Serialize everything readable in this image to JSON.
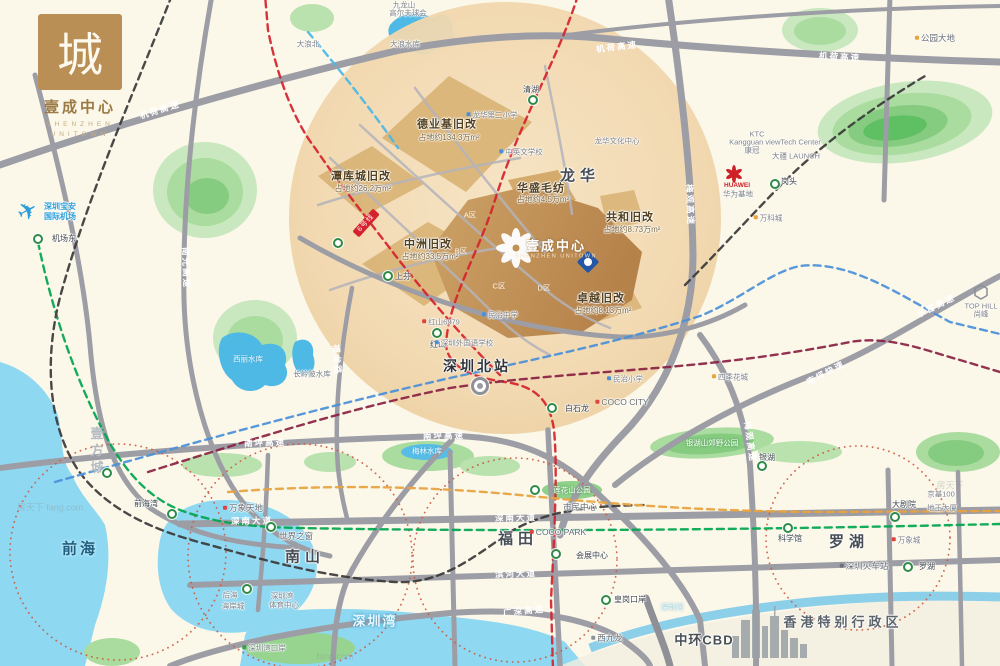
{
  "brand": {
    "logo_char": "城",
    "title": "壹成中心",
    "subtitle1": "SHENZHEN",
    "subtitle2": "UNITOWN"
  },
  "palette": {
    "land": "#fbf7e9",
    "sea": "#8ed8f2",
    "lake": "#4fb9e6",
    "park_outer": "#c9e8bf",
    "park_inner": "#86cc80",
    "road": "#9d9da5",
    "project_circle": "#efd3a6",
    "zone_block": "#d9b478",
    "project_block": "#c0914f",
    "metro_red": "#d5232e",
    "metro_green": "#00a650",
    "metro_blue": "#4a90d9",
    "metro_black": "#3a3a3a",
    "metro_orange": "#e8a33d",
    "metro_maroon": "#8a2243",
    "metro_cyan": "#49b8e8",
    "district_ring": "#cd5a3e"
  },
  "map": {
    "labels": [
      {
        "t": "机荷高速",
        "x": 160,
        "y": 110,
        "c": "road",
        "r": -17,
        "n": "road-jihe-expwy"
      },
      {
        "t": "机荷高速",
        "x": 617,
        "y": 47,
        "c": "road",
        "r": -7
      },
      {
        "t": "机荷高速",
        "x": 840,
        "y": 57,
        "c": "road",
        "r": 3
      },
      {
        "t": "南光高速",
        "x": 186,
        "y": 268,
        "c": "road",
        "r": 88,
        "n": "road-nanguang-expwy"
      },
      {
        "t": "梅观高速",
        "x": 690,
        "y": 205,
        "c": "road",
        "r": 88,
        "n": "road-meiguan-expwy"
      },
      {
        "t": "梅观高速",
        "x": 750,
        "y": 442,
        "c": "road",
        "r": 82
      },
      {
        "t": "南坪高速",
        "x": 265,
        "y": 443,
        "c": "road",
        "r": -2,
        "n": "road-nanping-expwy"
      },
      {
        "t": "南坪高速",
        "x": 444,
        "y": 436,
        "c": "road",
        "r": -1
      },
      {
        "t": "水官高速",
        "x": 936,
        "y": 306,
        "c": "road",
        "r": -26,
        "n": "road-shuiguan-expwy"
      },
      {
        "t": "南坪快速",
        "x": 826,
        "y": 373,
        "c": "road",
        "r": -28
      },
      {
        "t": "深南大道",
        "x": 252,
        "y": 521,
        "c": "road",
        "r": -1,
        "n": "road-shennan-avenue"
      },
      {
        "t": "深南大道",
        "x": 516,
        "y": 518,
        "c": "road",
        "r": -1
      },
      {
        "t": "滨河大道",
        "x": 516,
        "y": 574,
        "c": "road",
        "r": -2,
        "n": "road-binhe-avenue"
      },
      {
        "t": "广深高速",
        "x": 524,
        "y": 611,
        "c": "road",
        "r": -5,
        "n": "road-guangshen-expwy"
      },
      {
        "t": "福龙路",
        "x": 337,
        "y": 360,
        "c": "road",
        "r": 86,
        "n": "road-fulong-road"
      },
      {
        "t": "龙华",
        "x": 580,
        "y": 176,
        "c": "dist halo",
        "n": "district-longhua"
      },
      {
        "t": "南山",
        "x": 305,
        "y": 557,
        "c": "dist halo",
        "n": "district-nanshan"
      },
      {
        "t": "福田",
        "x": 518,
        "y": 539,
        "c": "dist halo",
        "n": "district-futian"
      },
      {
        "t": "罗湖",
        "x": 849,
        "y": 542,
        "c": "dist halo",
        "n": "district-luohu"
      },
      {
        "t": "前海",
        "x": 80,
        "y": 549,
        "c": "distw",
        "n": "district-qianhai"
      },
      {
        "t": "深圳湾",
        "x": 375,
        "y": 621,
        "c": "watbig",
        "n": "shenzhen-bay-label"
      },
      {
        "t": "香港特别行政区",
        "x": 843,
        "y": 622,
        "c": "hk halo",
        "n": "hongkong-sar-label"
      },
      {
        "t": "中环CBD",
        "x": 704,
        "y": 640,
        "c": "cbd halo",
        "n": "central-cbd-label"
      },
      {
        "t": "西九龙",
        "x": 607,
        "y": 638,
        "c": "poi halo",
        "d": "#8d939a"
      },
      {
        "t": "深圳河",
        "x": 672,
        "y": 607,
        "c": "wat"
      },
      {
        "t": "深圳北站",
        "x": 477,
        "y": 366,
        "c": "bigstn halo",
        "n": "shenzhen-north-station-label"
      },
      {
        "t": "德业基旧改",
        "x": 447,
        "y": 125,
        "c": "zone halo",
        "n": "zone-deyeji"
      },
      {
        "t": "占地约134.3万m²",
        "x": 449,
        "y": 138,
        "c": "zsub halo"
      },
      {
        "t": "潭库城旧改",
        "x": 361,
        "y": 177,
        "c": "zone halo",
        "n": "zone-tankucheng"
      },
      {
        "t": "占地约26.2万m²",
        "x": 363,
        "y": 189,
        "c": "zsub halo"
      },
      {
        "t": "中洲旧改",
        "x": 428,
        "y": 245,
        "c": "zone halo",
        "n": "zone-zhongzhou"
      },
      {
        "t": "占地约33.5万m²",
        "x": 430,
        "y": 257,
        "c": "zsub halo"
      },
      {
        "t": "华盛毛纺",
        "x": 541,
        "y": 189,
        "c": "zone halo",
        "n": "zone-huasheng"
      },
      {
        "t": "占地约4.5万m²",
        "x": 543,
        "y": 200,
        "c": "zsub halo"
      },
      {
        "t": "共和旧改",
        "x": 630,
        "y": 218,
        "c": "zone halo",
        "n": "zone-gonghe"
      },
      {
        "t": "占地约8.73万m²",
        "x": 632,
        "y": 230,
        "c": "zsub halo"
      },
      {
        "t": "卓越旧改",
        "x": 601,
        "y": 299,
        "c": "zone halo",
        "n": "zone-zhuoyue"
      },
      {
        "t": "占地约8.13万m²",
        "x": 603,
        "y": 311,
        "c": "zsub halo"
      },
      {
        "t": "A区",
        "x": 470,
        "y": 215,
        "c": "blk"
      },
      {
        "t": "B区",
        "x": 461,
        "y": 251,
        "c": "blk"
      },
      {
        "t": "C区",
        "x": 499,
        "y": 286,
        "c": "blk"
      },
      {
        "t": "D区",
        "x": 544,
        "y": 288,
        "c": "blk"
      },
      {
        "t": "壹成中心",
        "x": 556,
        "y": 246,
        "c": "projt",
        "n": "project-name"
      },
      {
        "t": "SHENZHEN UNITOWN",
        "x": 556,
        "y": 257,
        "c": "projs",
        "n": "project-name-en"
      },
      {
        "t": "清湖",
        "x": 531,
        "y": 90,
        "c": "stn halo"
      },
      {
        "t": "上芬",
        "x": 403,
        "y": 277,
        "c": "stn halo"
      },
      {
        "t": "红山",
        "x": 438,
        "y": 345,
        "c": "stn halo"
      },
      {
        "t": "白石龙",
        "x": 577,
        "y": 409,
        "c": "stn halo"
      },
      {
        "t": "机场东",
        "x": 64,
        "y": 239,
        "c": "stn halo"
      },
      {
        "t": "前海湾",
        "x": 146,
        "y": 504,
        "c": "stn halo"
      },
      {
        "t": "会展中心",
        "x": 592,
        "y": 556,
        "c": "stn halo"
      },
      {
        "t": "科学馆",
        "x": 790,
        "y": 539,
        "c": "stn halo"
      },
      {
        "t": "大剧院",
        "x": 904,
        "y": 505,
        "c": "stn halo"
      },
      {
        "t": "罗湖",
        "x": 927,
        "y": 567,
        "c": "stn halo"
      },
      {
        "t": "银湖",
        "x": 767,
        "y": 458,
        "c": "stn halo"
      },
      {
        "t": "皇岗口岸",
        "x": 630,
        "y": 600,
        "c": "stn halo"
      },
      {
        "t": "岗头",
        "x": 789,
        "y": 182,
        "c": "stn halo"
      },
      {
        "t": "世界之窗",
        "x": 296,
        "y": 536,
        "c": "poi halo"
      },
      {
        "t": "万象天地",
        "x": 243,
        "y": 508,
        "c": "poi halo",
        "d": "#e0433f"
      },
      {
        "t": "后海",
        "x": 230,
        "y": 595,
        "c": "tiny halo"
      },
      {
        "t": "海岸城",
        "x": 233,
        "y": 606,
        "c": "tiny halo"
      },
      {
        "t": "深圳湾",
        "x": 282,
        "y": 596,
        "c": "tiny halo"
      },
      {
        "t": "体育中心",
        "x": 284,
        "y": 605,
        "c": "tiny halo"
      },
      {
        "t": "市民中心",
        "x": 580,
        "y": 507,
        "c": "poi halo"
      },
      {
        "t": "COCO PARK",
        "x": 558,
        "y": 532,
        "c": "poi halo",
        "d": "#e0433f"
      },
      {
        "t": "莲花山公园",
        "x": 572,
        "y": 490,
        "c": "park"
      },
      {
        "t": "京基100",
        "x": 941,
        "y": 494,
        "c": "tiny halo"
      },
      {
        "t": "地王大厦",
        "x": 942,
        "y": 508,
        "c": "tiny halo"
      },
      {
        "t": "万象城",
        "x": 906,
        "y": 540,
        "c": "tiny halo",
        "d": "#e0433f"
      },
      {
        "t": "深圳火车站",
        "x": 864,
        "y": 566,
        "c": "poi halo",
        "d": "#6e747b"
      },
      {
        "t": "银湖山郊野公园",
        "x": 712,
        "y": 443,
        "c": "park"
      },
      {
        "t": "梅林水库",
        "x": 427,
        "y": 451,
        "c": "wat"
      },
      {
        "t": "西丽水库",
        "x": 248,
        "y": 359,
        "c": "wat"
      },
      {
        "t": "长岭陂水库",
        "x": 312,
        "y": 374,
        "c": "tiny halo"
      },
      {
        "t": "COCO CITY",
        "x": 622,
        "y": 402,
        "c": "poi halo",
        "d": "#e0433f"
      },
      {
        "t": "民治小学",
        "x": 625,
        "y": 379,
        "c": "tiny halo",
        "d": "#4a90d9"
      },
      {
        "t": "四季花城",
        "x": 730,
        "y": 377,
        "c": "tiny halo",
        "d": "#e8a33d"
      },
      {
        "t": "民治中学",
        "x": 500,
        "y": 315,
        "c": "tiny halo",
        "d": "#4a90d9"
      },
      {
        "t": "红山6979",
        "x": 441,
        "y": 322,
        "c": "tiny halo",
        "d": "#e0433f"
      },
      {
        "t": "深圳外国语学校",
        "x": 464,
        "y": 343,
        "c": "tiny halo",
        "d": "#4a90d9"
      },
      {
        "t": "龙华第二小学",
        "x": 492,
        "y": 115,
        "c": "tiny halo",
        "d": "#4a90d9"
      },
      {
        "t": "中英文学校",
        "x": 521,
        "y": 152,
        "c": "tiny halo",
        "d": "#4a90d9"
      },
      {
        "t": "龙华文化中心",
        "x": 617,
        "y": 141,
        "c": "tiny halo"
      },
      {
        "t": "万科城",
        "x": 768,
        "y": 218,
        "c": "tiny halo",
        "d": "#e8a33d"
      },
      {
        "t": "KTC",
        "x": 757,
        "y": 134,
        "c": "tiny halo"
      },
      {
        "t": "Kangguan viewTech Center",
        "x": 775,
        "y": 142,
        "c": "tiny halo"
      },
      {
        "t": "康冠",
        "x": 752,
        "y": 150,
        "c": "tiny halo"
      },
      {
        "t": "大疆 LAUNCH",
        "x": 796,
        "y": 156,
        "c": "tiny halo"
      },
      {
        "t": "HUAWEI",
        "x": 737,
        "y": 186,
        "c": "huawei",
        "n": "huawei-label"
      },
      {
        "t": "华为基地",
        "x": 738,
        "y": 194,
        "c": "tiny halo"
      },
      {
        "t": "公园大地",
        "x": 935,
        "y": 38,
        "c": "poi halo",
        "d": "#e8a33d"
      },
      {
        "t": "大浪北",
        "x": 308,
        "y": 44,
        "c": "tiny halo"
      },
      {
        "t": "九龙山",
        "x": 404,
        "y": 5,
        "c": "tiny halo"
      },
      {
        "t": "高尔夫球会",
        "x": 408,
        "y": 13,
        "c": "tiny halo"
      },
      {
        "t": "大浪水库",
        "x": 405,
        "y": 44,
        "c": "tiny halo"
      },
      {
        "t": "TOP HILL",
        "x": 981,
        "y": 306,
        "c": "tiny halo",
        "n": "tophill-label"
      },
      {
        "t": "尚峰",
        "x": 981,
        "y": 314,
        "c": "tiny halo"
      },
      {
        "t": "深圳宝安",
        "x": 60,
        "y": 207,
        "c": "apt halo",
        "n": "airport-label"
      },
      {
        "t": "国际机场",
        "x": 60,
        "y": 217,
        "c": "apt halo"
      },
      {
        "t": "深圳湾口岸",
        "x": 264,
        "y": 648,
        "c": "tiny halo",
        "d": "#3d9c50"
      },
      {
        "t": "✈",
        "x": 28,
        "y": 212,
        "c": "plane",
        "r": -28,
        "n": "airport-plane-icon"
      },
      {
        "t": "6号线",
        "x": 366,
        "y": 223,
        "c": "badge",
        "r": -48,
        "n": "metro-line6-badge"
      },
      {
        "t": "壹方城",
        "x": 96,
        "y": 452,
        "c": "brandv",
        "n": "uniworld-brand-label"
      },
      {
        "t": "房天下 fang.com",
        "x": 50,
        "y": 508,
        "c": "wm",
        "n": "watermark"
      },
      {
        "t": "房天下",
        "x": 950,
        "y": 486,
        "c": "wm",
        "n": "watermark"
      },
      {
        "t": "fang.com",
        "x": 335,
        "y": 657,
        "c": "wm",
        "n": "watermark"
      }
    ],
    "stations": [
      [
        38,
        239,
        "g"
      ],
      [
        533,
        100,
        "g"
      ],
      [
        388,
        276,
        "g"
      ],
      [
        338,
        243,
        "g"
      ],
      [
        437,
        333,
        "g"
      ],
      [
        480,
        386,
        "h"
      ],
      [
        552,
        408,
        "g"
      ],
      [
        556,
        554,
        "g"
      ],
      [
        271,
        527,
        "g"
      ],
      [
        172,
        514,
        "g"
      ],
      [
        107,
        473,
        "g"
      ],
      [
        247,
        589,
        "g"
      ],
      [
        535,
        490,
        "g"
      ],
      [
        788,
        528,
        "g"
      ],
      [
        895,
        517,
        "g"
      ],
      [
        908,
        567,
        "g"
      ],
      [
        762,
        466,
        "g"
      ],
      [
        606,
        600,
        "g"
      ],
      [
        775,
        184,
        "g"
      ]
    ]
  }
}
